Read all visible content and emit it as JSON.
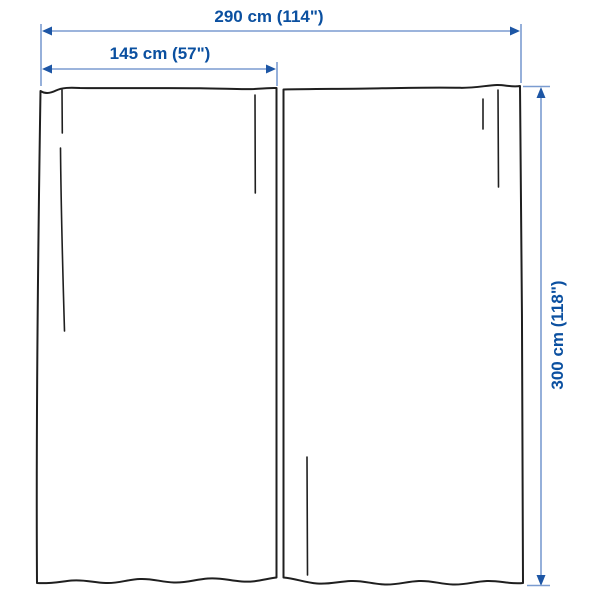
{
  "diagram": {
    "title": "curtain-pair-measurement-diagram",
    "dimensions": {
      "total_width_label": "290 cm (114\")",
      "panel_width_label": "145 cm (57\")",
      "height_label": "300 cm (118\")"
    }
  },
  "colors": {
    "label_text": "#0b50a0",
    "dimension_line": "#7b9cd0",
    "arrowhead": "#1d56a5",
    "curtain_outline": "#1f1f1f",
    "background": "#ffffff"
  }
}
